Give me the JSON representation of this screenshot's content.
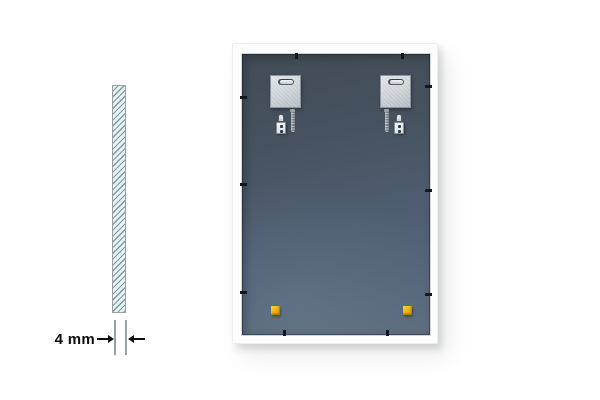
{
  "meta": {
    "description": "Product illustration: back view of a white rectangular mirror frame with hanging hardware, beside a hatched glass cross-section annotated with its thickness."
  },
  "canvas": {
    "background_color": "#ffffff",
    "width": 600,
    "height": 400
  },
  "thickness_diagram": {
    "label": "4 mm",
    "glass": {
      "fill": "#e7f3f2",
      "hatch_color": "#7c9aa1",
      "border_color": "#97a1a3"
    },
    "extension_line_color": "#9aa0a2",
    "arrow_color": "#0d0d0d"
  },
  "frame_back": {
    "frame_color": "#fdfdfd",
    "panel_gradient": [
      "#414c56",
      "#46525f",
      "#4e5d70",
      "#5d6d7f"
    ],
    "hanger_plates": {
      "count": 2,
      "color": "#cfd5d9",
      "slot_type": "capsule-slot"
    },
    "hook_sets": {
      "count": 2,
      "parts": [
        "hanging-hook",
        "screw"
      ]
    },
    "corner_bumpers": {
      "count": 2,
      "color": "#f2a90a"
    },
    "retainer_tabs": {
      "color": "#14171a",
      "top": 2,
      "right": 3,
      "bottom": 2,
      "left": 3
    }
  }
}
